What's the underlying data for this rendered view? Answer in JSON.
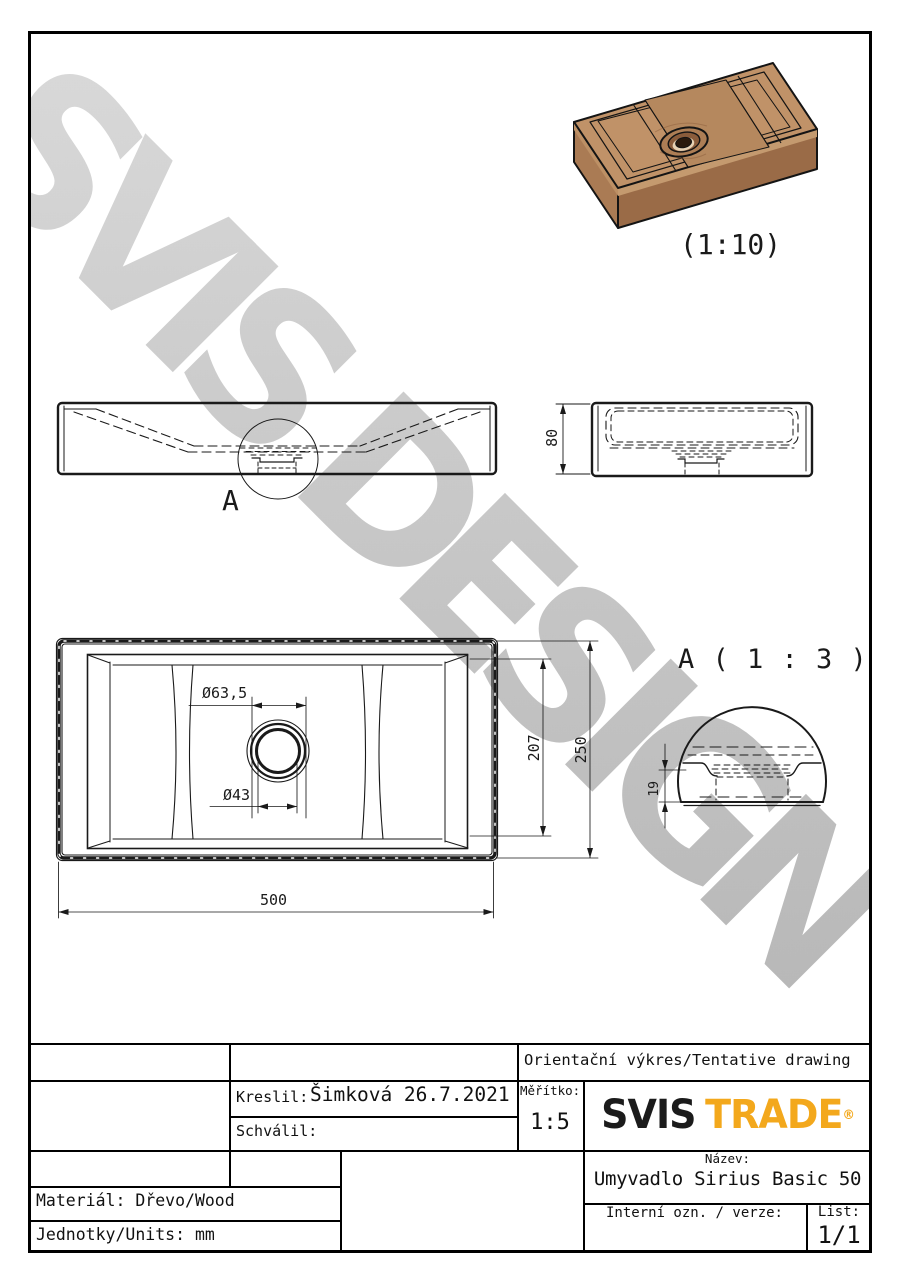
{
  "drawing": {
    "iso_scale_label": "(1:10)",
    "front_detail_label": "A",
    "detail_title": "A ( 1 : 3 )",
    "dims": {
      "height": "80",
      "drain_flange_dia": "Ø63,5",
      "drain_hole_dia": "Ø43",
      "basin_inner_depth": "207",
      "depth": "250",
      "width": "500",
      "detail_rim_height": "19"
    }
  },
  "watermark": {
    "text": "SVIS DESIGN"
  },
  "title_block": {
    "tentative_note": "Orientační výkres/Tentative drawing",
    "drawn_by_label": "Kreslil:",
    "drawn_by_value": "Šimková 26.7.2021",
    "approved_by_label": "Schválil:",
    "scale_label": "Měřítko:",
    "scale_value": "1:5",
    "logo": {
      "text_primary": "SVIS",
      "text_secondary": "TRADE",
      "registered_mark": "®",
      "accent_color": "#f3a81c"
    },
    "name_label": "Název:",
    "name_value": "Umyvadlo Sirius Basic 50",
    "material": "Materiál: Dřevo/Wood",
    "units": "Jednotky/Units: mm",
    "internal_ref_label": "Interní ozn. / verze:",
    "sheet_label": "List:",
    "sheet_value": "1/1"
  },
  "colors": {
    "line": "#1a1a1a",
    "watermark_gray": "#c6c6c6",
    "logo_accent": "#f3a81c",
    "wood_top": "#c09268",
    "wood_left": "#aa7b54",
    "wood_front": "#9a6b47"
  }
}
